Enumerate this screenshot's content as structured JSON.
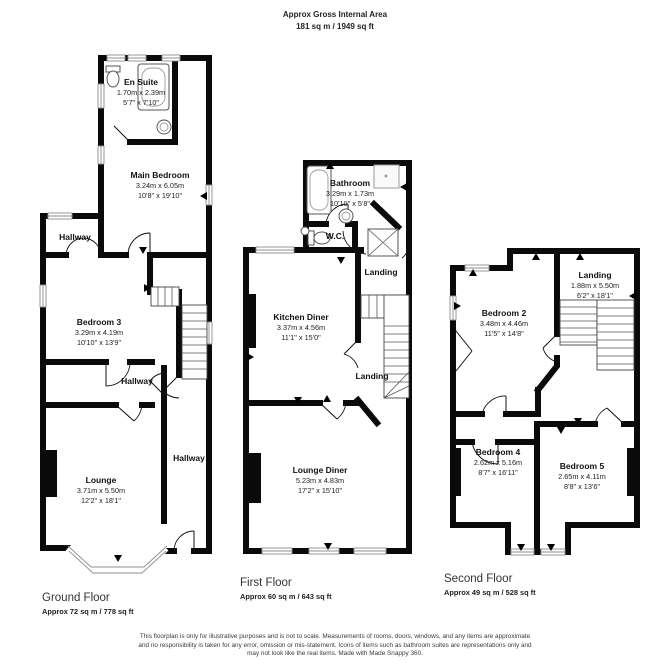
{
  "header": {
    "title": "Approx Gross Internal Area",
    "subtitle": "181 sq m / 1949 sq ft"
  },
  "floors": [
    {
      "label": "Ground Floor",
      "area": "Approx 72 sq m / 778 sq ft",
      "rooms": [
        {
          "name": "En Suite",
          "metric": "1.70m x 2.39m",
          "imperial": "5'7\" x 7'10\""
        },
        {
          "name": "Main Bedroom",
          "metric": "3.24m x 6.05m",
          "imperial": "10'8\" x 19'10\""
        },
        {
          "name": "Hallway"
        },
        {
          "name": "Bedroom 3",
          "metric": "3.29m x 4.19m",
          "imperial": "10'10\" x 13'9\""
        },
        {
          "name": "Hallway"
        },
        {
          "name": "Hallway"
        },
        {
          "name": "Lounge",
          "metric": "3.71m x 5.50m",
          "imperial": "12'2\" x 18'1\""
        }
      ]
    },
    {
      "label": "First Floor",
      "area": "Approx 60 sq m / 643 sq ft",
      "rooms": [
        {
          "name": "Bathroom",
          "metric": "3.29m x 1.73m",
          "imperial": "10'10\" x 5'8\""
        },
        {
          "name": "W.C."
        },
        {
          "name": "Landing"
        },
        {
          "name": "Kitchen Diner",
          "metric": "3.37m x 4.56m",
          "imperial": "11'1\" x 15'0\""
        },
        {
          "name": "Landing"
        },
        {
          "name": "Lounge Diner",
          "metric": "5.23m x 4.83m",
          "imperial": "17'2\" x 15'10\""
        }
      ]
    },
    {
      "label": "Second Floor",
      "area": "Approx 49 sq m / 528 sq ft",
      "rooms": [
        {
          "name": "Bedroom 2",
          "metric": "3.48m x 4.46m",
          "imperial": "11'5\" x 14'8\""
        },
        {
          "name": "Landing",
          "metric": "1.88m x 5.50m",
          "imperial": "6'2\" x 18'1\""
        },
        {
          "name": "Bedroom 4",
          "metric": "2.62m x 5.16m",
          "imperial": "8'7\" x 16'11\""
        },
        {
          "name": "Bedroom 5",
          "metric": "2.65m x 4.11m",
          "imperial": "8'8\" x 13'6\""
        }
      ]
    }
  ],
  "footer": {
    "line1": "This floorplan is only for illustrative purposes and is not to scale. Measurements of rooms, doors, windows, and any items are approximate",
    "line2": "and no responsibility is taken for any error, omission or mis-statement. Icons of items such as bathroom suites are representations only and",
    "line3": "may not look like the real items. Made with Made Snappy 360."
  },
  "colors": {
    "wall": "#0a0a0a",
    "window": "#8f8f8f",
    "text": "#111111",
    "muted": "#3a3a3a"
  }
}
